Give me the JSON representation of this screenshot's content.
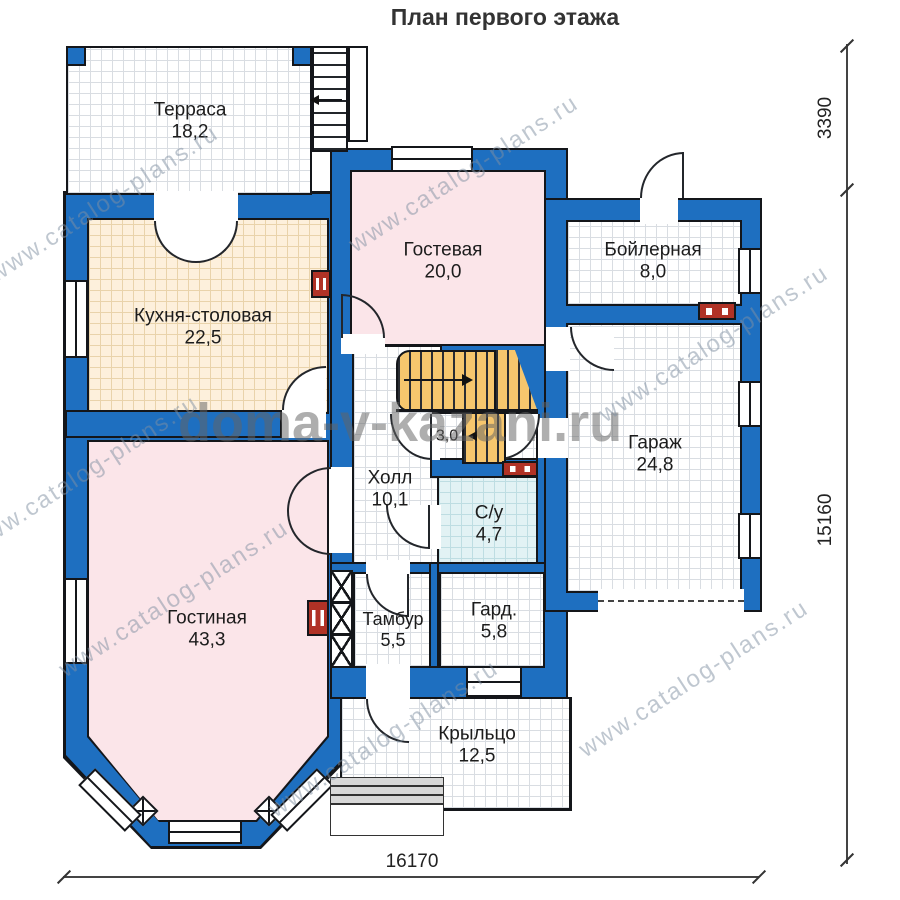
{
  "title": "План первого этажа",
  "rooms": {
    "terrace": {
      "name": "Терраса",
      "area": "18,2"
    },
    "kitchen": {
      "name": "Кухня-столовая",
      "area": "22,5"
    },
    "guest": {
      "name": "Гостевая",
      "area": "20,0"
    },
    "boiler": {
      "name": "Бойлерная",
      "area": "8,0"
    },
    "garage": {
      "name": "Гараж",
      "area": "24,8"
    },
    "hall": {
      "name": "Холл",
      "area": "10,1"
    },
    "stair_passage": {
      "area": "3,0"
    },
    "bathroom": {
      "name": "С/у",
      "area": "4,7"
    },
    "living": {
      "name": "Гостиная",
      "area": "43,3"
    },
    "vestibule": {
      "name": "Тамбур",
      "area": "5,5"
    },
    "wardrobe": {
      "name": "Гард.",
      "area": "5,8"
    },
    "porch": {
      "name": "Крыльцо",
      "area": "12,5"
    }
  },
  "dimensions": {
    "height_top": "3390",
    "height_main": "15160",
    "width_bottom": "16170"
  },
  "watermarks": {
    "center": "doma-v-kazani.ru",
    "diagonal": "www.catalog-plans.ru"
  },
  "colors": {
    "wall": "#1e6fc0",
    "room-pink": "#fbe5e9",
    "room-beige": "#fdf0dc",
    "room-cyan": "#e2f2f4",
    "grid-line": "#d9dde2",
    "grid-beige-line": "#e9d3ab",
    "grid-cyan-line": "#bedde2",
    "stair": "#f6c66d",
    "accent-red": "#b03226"
  }
}
